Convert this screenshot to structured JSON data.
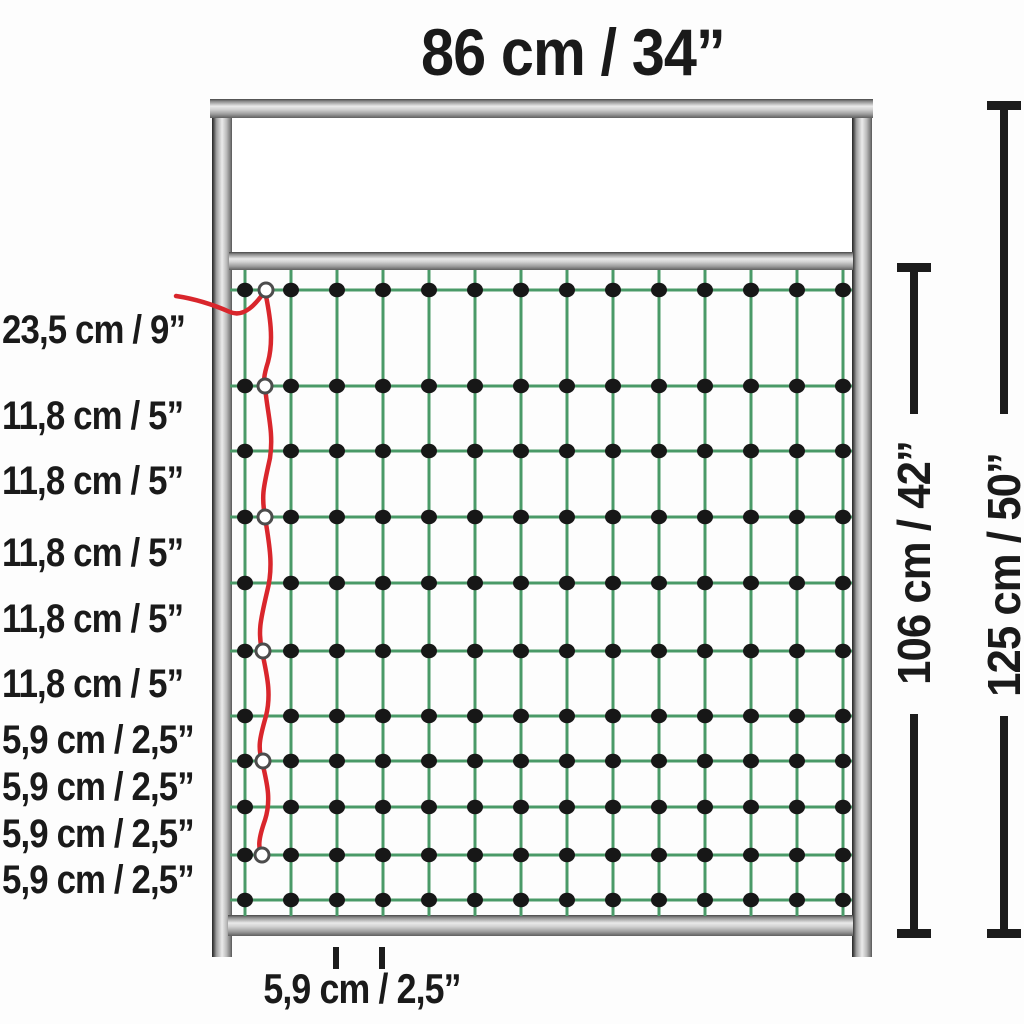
{
  "diagram": {
    "title": "Poultry netting gate dimension diagram",
    "top_width_label": "86 cm / 34”",
    "left_measurements": [
      "23,5 cm / 9”",
      "11,8 cm / 5”",
      "11,8 cm / 5”",
      "11,8 cm / 5”",
      "11,8 cm / 5”",
      "11,8 cm / 5”",
      "5,9 cm / 2,5”",
      "5,9 cm / 2,5”",
      "5,9 cm / 2,5”",
      "5,9 cm / 2,5”"
    ],
    "net_height_label": "106 cm / 42”",
    "total_height_label": "125 cm / 50”",
    "mesh_width_label": "5,9 cm / 2,5”"
  },
  "colors": {
    "net_strand": "#4a9a68",
    "knot": "#171717",
    "live_wire": "#d9262c",
    "ring_stroke": "#4c4c4c",
    "ring_fill": "#ffffff",
    "dimension_line": "#1c1c1c",
    "text": "#1a1a1a",
    "frame_light": "#e9e9e9",
    "frame_dark": "#3f3f3f"
  },
  "net": {
    "cols_x": [
      245,
      291,
      337,
      383,
      429,
      475,
      521,
      567,
      613,
      659,
      705,
      751,
      797,
      843
    ],
    "rows_y": [
      290,
      386,
      451,
      517,
      583,
      651,
      716,
      761,
      807,
      855,
      900
    ],
    "x_min": 230,
    "x_max": 852,
    "y_min": 270,
    "y_max": 916,
    "knot_rx": 8,
    "knot_ry": 7.2,
    "strand_width": 3,
    "red": {
      "path": "M176,296 C196,299 214,305 230,312 C244,318 256,304 265,291 C270,315 274,340 268,362 C263,378 264,381 265,386 C267,412 274,432 270,458 C264,486 261,494 265,517 C269,543 274,566 267,592 C260,622 258,632 262,651 C266,672 272,692 266,716 C259,740 258,748 262,761 C266,780 272,798 265,820 C258,840 258,848 262,855",
      "width": 4.5,
      "rings": [
        [
          266,
          290
        ],
        [
          265,
          386
        ],
        [
          265,
          517
        ],
        [
          263,
          651
        ],
        [
          263,
          761
        ],
        [
          262,
          855
        ]
      ],
      "ring_r": 7
    }
  }
}
